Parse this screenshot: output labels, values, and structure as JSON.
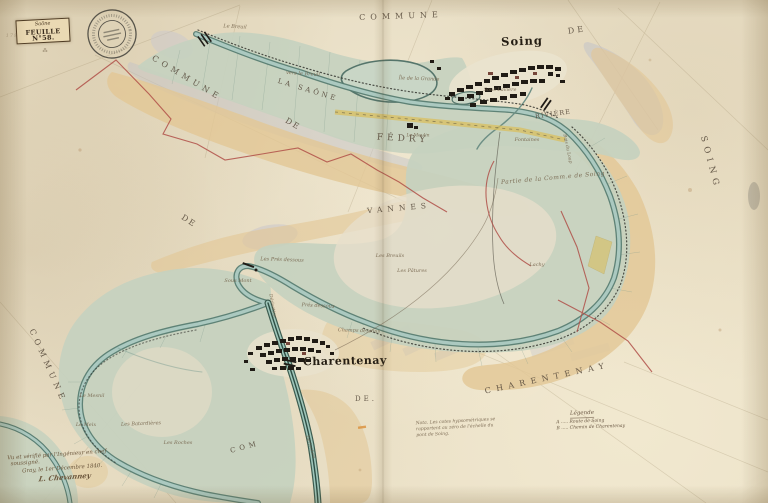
{
  "cartouche": {
    "river": "Saône",
    "sheet": "FEUILLE N°58."
  },
  "stamp": {
    "type": "circular-ink-stamp"
  },
  "legend": {
    "title": "Légende",
    "items": [
      {
        "key": "A",
        "text": "A ..... Route de Soing"
      },
      {
        "key": "B",
        "text": "B ..... Chemin de Charentenay"
      }
    ]
  },
  "signature": {
    "lines": [
      "Vu et vérifié par l'Ingénieur en chef",
      "soussigné.",
      "Gray, le 1er Décembre 1840.",
      "L. Chevanney"
    ]
  },
  "nota": {
    "text": "Nota. Les cotes hypsométriques se rapportent au zéro de l'échelle du pont de Soing."
  },
  "colors": {
    "paper": "#e9dfc6",
    "floodplain_green": "#c6d1bf",
    "water": "#abc9c0",
    "water_edge": "#587d72",
    "bank_tan": "#e2c795",
    "parcel_grey": "#c3c3c8",
    "boundary_red": "#b04f48",
    "road_yellow": "#d9bf5e",
    "ink": "#201b15",
    "label_sepia": "#75644c"
  },
  "map_labels": [
    {
      "name": "label-commune-top",
      "text": "COMMUNE",
      "x": 401,
      "y": 16,
      "rot": -2,
      "size": 8,
      "ls": 5,
      "cls": "sc"
    },
    {
      "name": "label-de-top-right",
      "text": "DE",
      "x": 577,
      "y": 30,
      "rot": -8,
      "size": 8,
      "ls": 3,
      "cls": "sc"
    },
    {
      "name": "label-soing-town",
      "text": "Soing",
      "x": 522,
      "y": 41,
      "rot": -2,
      "size": 11.5,
      "ls": 1,
      "cls": "town"
    },
    {
      "name": "label-soing-right-edge",
      "text": "SOING",
      "x": 710,
      "y": 163,
      "rot": 75,
      "size": 8.5,
      "ls": 5,
      "cls": "sc"
    },
    {
      "name": "label-commune-nw",
      "text": "COMMUNE",
      "x": 187,
      "y": 78,
      "rot": 31,
      "size": 8,
      "ls": 4.5,
      "cls": "sc"
    },
    {
      "name": "label-de-nw",
      "text": "DE",
      "x": 293,
      "y": 124,
      "rot": 31,
      "size": 8,
      "ls": 2,
      "cls": "sc"
    },
    {
      "name": "label-fedry",
      "text": "FÉDRY",
      "x": 403,
      "y": 139,
      "rot": 3,
      "size": 9,
      "ls": 4,
      "cls": "sc"
    },
    {
      "name": "label-la-saone",
      "text": "LA SAÔNE",
      "x": 308,
      "y": 90,
      "rot": 17,
      "size": 7,
      "ls": 3,
      "cls": "sc"
    },
    {
      "name": "label-riviere",
      "text": "RIVIÈRE",
      "x": 553,
      "y": 114,
      "rot": -8,
      "size": 6.5,
      "ls": 1,
      "cls": "sc"
    },
    {
      "name": "label-partie-comm-soing",
      "text": "Partie de la Comm.e de Soing",
      "x": 553,
      "y": 178,
      "rot": -5,
      "size": 6,
      "ls": 0.5,
      "cls": "micro"
    },
    {
      "name": "label-vannes",
      "text": "VANNES",
      "x": 399,
      "y": 208,
      "rot": -5,
      "size": 7.5,
      "ls": 5,
      "cls": "sc"
    },
    {
      "name": "label-de-mid",
      "text": "DE",
      "x": 189,
      "y": 221,
      "rot": 33,
      "size": 8,
      "ls": 2,
      "cls": "sc"
    },
    {
      "name": "label-charentenay-town",
      "text": "Charentenay",
      "x": 345,
      "y": 361,
      "rot": -1,
      "size": 11,
      "ls": 0.5,
      "cls": "town"
    },
    {
      "name": "label-de-bottom",
      "text": "DE.",
      "x": 366,
      "y": 399,
      "rot": 0,
      "size": 7,
      "ls": 3,
      "cls": "sc"
    },
    {
      "name": "label-charentenay-diag",
      "text": "CHARENTENAY",
      "x": 547,
      "y": 378,
      "rot": -12,
      "size": 8,
      "ls": 5.5,
      "cls": "sc"
    },
    {
      "name": "label-commune-sw",
      "text": "COMMUNE",
      "x": 48,
      "y": 366,
      "rot": 66,
      "size": 8,
      "ls": 4.5,
      "cls": "sc"
    },
    {
      "name": "label-com-bottom",
      "text": "COM",
      "x": 245,
      "y": 447,
      "rot": -15,
      "size": 7,
      "ls": 4,
      "cls": "sc"
    },
    {
      "name": "label-pencil-number",
      "text": "179",
      "x": 12,
      "y": 36,
      "rot": 0,
      "size": 5,
      "ls": 1,
      "cls": "micro faint"
    },
    {
      "name": "label-cartouche-mark",
      "text": "⁂",
      "x": 45,
      "y": 51,
      "rot": 0,
      "size": 5,
      "ls": 0,
      "cls": "micro"
    },
    {
      "name": "label-le-breuil-top",
      "text": "Le Breuil",
      "x": 235,
      "y": 27,
      "rot": 3,
      "size": 5,
      "ls": 0,
      "cls": "micro"
    },
    {
      "name": "label-vers-le-breuil",
      "text": "vers le Breuil",
      "x": 303,
      "y": 74,
      "rot": 4,
      "size": 5,
      "ls": 0,
      "cls": "micro"
    },
    {
      "name": "label-ile-de-la-grande",
      "text": "Île de la Grande",
      "x": 419,
      "y": 79,
      "rot": 2,
      "size": 5,
      "ls": 0,
      "cls": "micro"
    },
    {
      "name": "label-sous-laviere",
      "text": "Sous Lavière",
      "x": 500,
      "y": 90,
      "rot": 0,
      "size": 5,
      "ls": 0,
      "cls": "micro"
    },
    {
      "name": "label-fontaines",
      "text": "Fontaines",
      "x": 527,
      "y": 140,
      "rot": 0,
      "size": 5,
      "ls": 0,
      "cls": "micro"
    },
    {
      "name": "label-bois-du-loup",
      "text": "Bois du Loup",
      "x": 567,
      "y": 149,
      "rot": 78,
      "size": 4.5,
      "ls": 0,
      "cls": "micro"
    },
    {
      "name": "label-le-moulin",
      "text": "Le Moulin",
      "x": 418,
      "y": 136,
      "rot": 0,
      "size": 4.5,
      "ls": 0,
      "cls": "micro"
    },
    {
      "name": "label-les-pres-dessous",
      "text": "Les Prés dessous",
      "x": 282,
      "y": 260,
      "rot": 2,
      "size": 5,
      "ls": 0,
      "cls": "micro"
    },
    {
      "name": "label-les-breuils",
      "text": "Les Breuils",
      "x": 390,
      "y": 256,
      "rot": 0,
      "size": 5,
      "ls": 0,
      "cls": "micro"
    },
    {
      "name": "label-les-patures",
      "text": "Les Pâtures",
      "x": 412,
      "y": 271,
      "rot": 0,
      "size": 5,
      "ls": 0,
      "cls": "micro"
    },
    {
      "name": "label-pres-dessous",
      "text": "Prés dessous",
      "x": 318,
      "y": 306,
      "rot": 3,
      "size": 5,
      "ls": 0,
      "cls": "micro"
    },
    {
      "name": "label-champs-dessous",
      "text": "Champs dessous",
      "x": 359,
      "y": 331,
      "rot": 2,
      "size": 5,
      "ls": 0,
      "cls": "micro"
    },
    {
      "name": "label-sous-mont",
      "text": "Sous Mont",
      "x": 238,
      "y": 281,
      "rot": 0,
      "size": 5,
      "ls": 0,
      "cls": "micro"
    },
    {
      "name": "label-lachy",
      "text": "Lachy",
      "x": 537,
      "y": 265,
      "rot": 0,
      "size": 5,
      "ls": 0,
      "cls": "micro"
    },
    {
      "name": "label-les-batardieres",
      "text": "Les Batardières",
      "x": 141,
      "y": 424,
      "rot": -2,
      "size": 5,
      "ls": 0,
      "cls": "micro"
    },
    {
      "name": "label-les-roches",
      "text": "Les Roches",
      "x": 178,
      "y": 443,
      "rot": 0,
      "size": 5,
      "ls": 0,
      "cls": "micro"
    },
    {
      "name": "label-le-mesnil",
      "text": "Le Mesnil",
      "x": 92,
      "y": 396,
      "rot": 0,
      "size": 5,
      "ls": 0,
      "cls": "micro"
    },
    {
      "name": "label-le-meix",
      "text": "Le Meix",
      "x": 86,
      "y": 425,
      "rot": 0,
      "size": 5,
      "ls": 0,
      "cls": "micro"
    },
    {
      "name": "label-derivation-1",
      "text": "Dérivation",
      "x": 272,
      "y": 306,
      "rot": 80,
      "size": 4.5,
      "ls": 0,
      "cls": "micro"
    },
    {
      "name": "label-derivation-2",
      "text": "Dérivation",
      "x": 310,
      "y": 447,
      "rot": 72,
      "size": 4.5,
      "ls": 0,
      "cls": "micro"
    }
  ]
}
